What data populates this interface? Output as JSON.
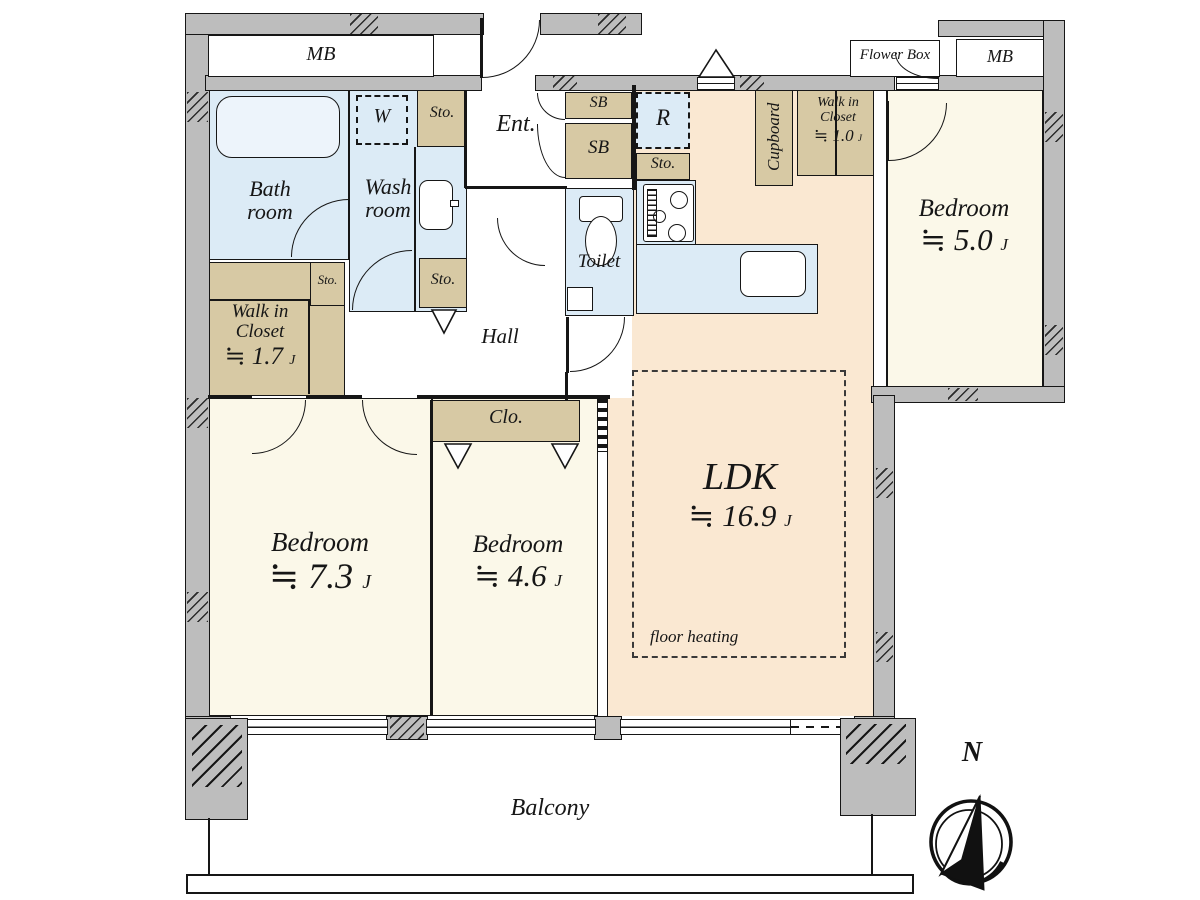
{
  "colors": {
    "wall_fill": "#bdbdbd",
    "outline": "#161616",
    "room_cream": "#fbf8e9",
    "room_peach": "#fae8d2",
    "wet_area_blue": "#dcebf6",
    "storage_tan": "#d7c9a4"
  },
  "rooms": {
    "ldk": {
      "name": "LDK",
      "size": "≒ 16.9",
      "unit": "J",
      "note": "floor heating"
    },
    "bedroom73": {
      "name": "Bedroom",
      "size": "≒ 7.3",
      "unit": "J"
    },
    "bedroom46": {
      "name": "Bedroom",
      "size": "≒ 4.6",
      "unit": "J"
    },
    "bedroom50": {
      "name": "Bedroom",
      "size": "≒ 5.0",
      "unit": "J"
    },
    "wic17": {
      "line1": "Walk in",
      "line2": "Closet",
      "size": "≒ 1.7",
      "unit": "J"
    },
    "wic10": {
      "line1": "Walk in",
      "line2": "Closet",
      "size": "≒ 1.0",
      "unit": "J"
    },
    "bath": {
      "line1": "Bath",
      "line2": "room"
    },
    "wash": {
      "line1": "Wash",
      "line2": "room"
    },
    "toilet": {
      "name": "Toilet"
    },
    "hall": {
      "name": "Hall"
    },
    "entrance": {
      "name": "Ent."
    },
    "balcony": {
      "name": "Balcony"
    }
  },
  "labels": {
    "meter_box": "MB",
    "flower_box": "Flower Box",
    "shoe_box": "SB",
    "storage": "Sto.",
    "closet": "Clo.",
    "cupboard": "Cupboard",
    "washer": "W",
    "refrigerator": "R",
    "north": "N"
  }
}
